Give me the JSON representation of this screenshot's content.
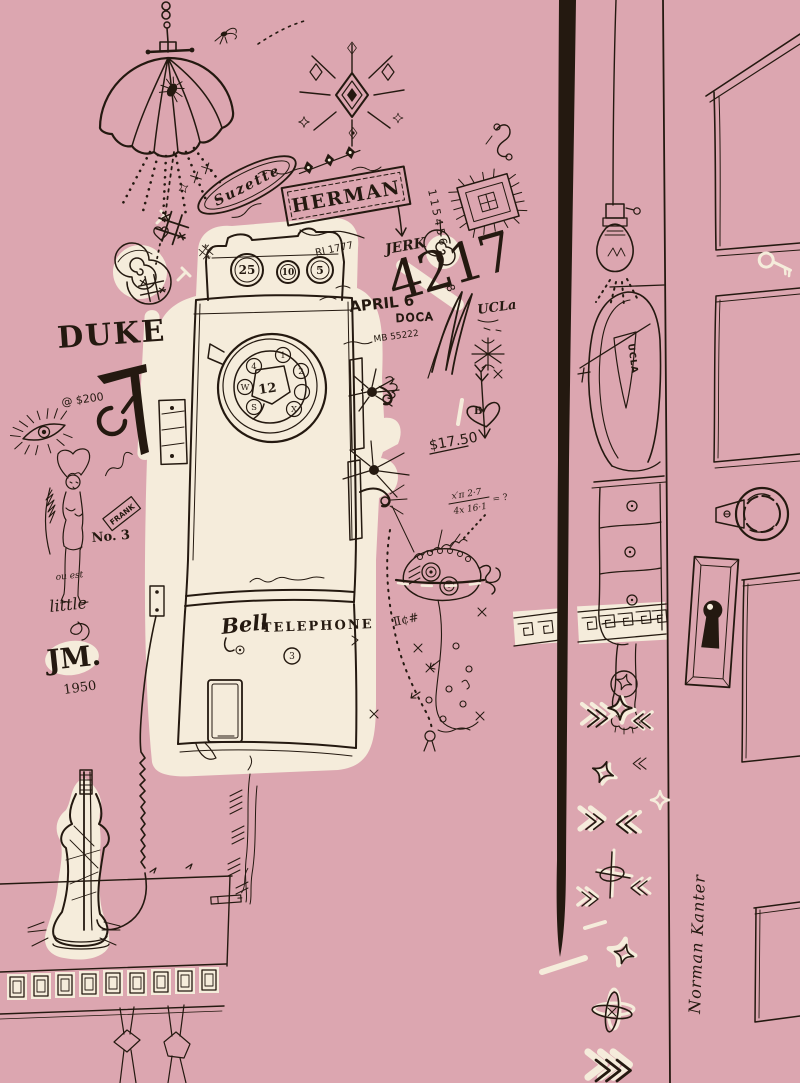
{
  "artwork": {
    "signature": "Norman Kanter",
    "colors": {
      "background": "#dca6b0",
      "ink": "#241910",
      "cream": "#f5ecdb"
    }
  },
  "graffiti": {
    "suzette": "Suzette",
    "herman": "HERMAN",
    "jerk": "JERK",
    "big_number": "4217",
    "april": "APRIL 6",
    "doca": "DOCA",
    "mb_number": "MB 55222",
    "ri_number": "RI 1777",
    "ucla": "UCLa",
    "vertical_number": "115456",
    "vertical_number_extra": "8",
    "duke": "DUKE",
    "at_price": "@ $200",
    "no3": "No. 3",
    "frank": "FRANK",
    "ou_est": "ou est",
    "little": "little",
    "jm": "JM.",
    "jm_year": "1950",
    "price": "$17.50",
    "heart_letter": "B",
    "formula_top": "x′π 2·7",
    "formula_bottom": "4x 16·1",
    "formula_result": "= ?",
    "cent_marks": "Ⅱ¢#"
  },
  "phone": {
    "coin_slots": [
      "25",
      "10",
      "5"
    ],
    "brand": "Bell",
    "brand2": "TELEPHONE",
    "dial_center": "12",
    "dial_labels": [
      "1",
      "2",
      "4",
      "W",
      "S",
      "X"
    ],
    "lower_number": "3"
  },
  "pennant": {
    "label": "UCLA"
  }
}
